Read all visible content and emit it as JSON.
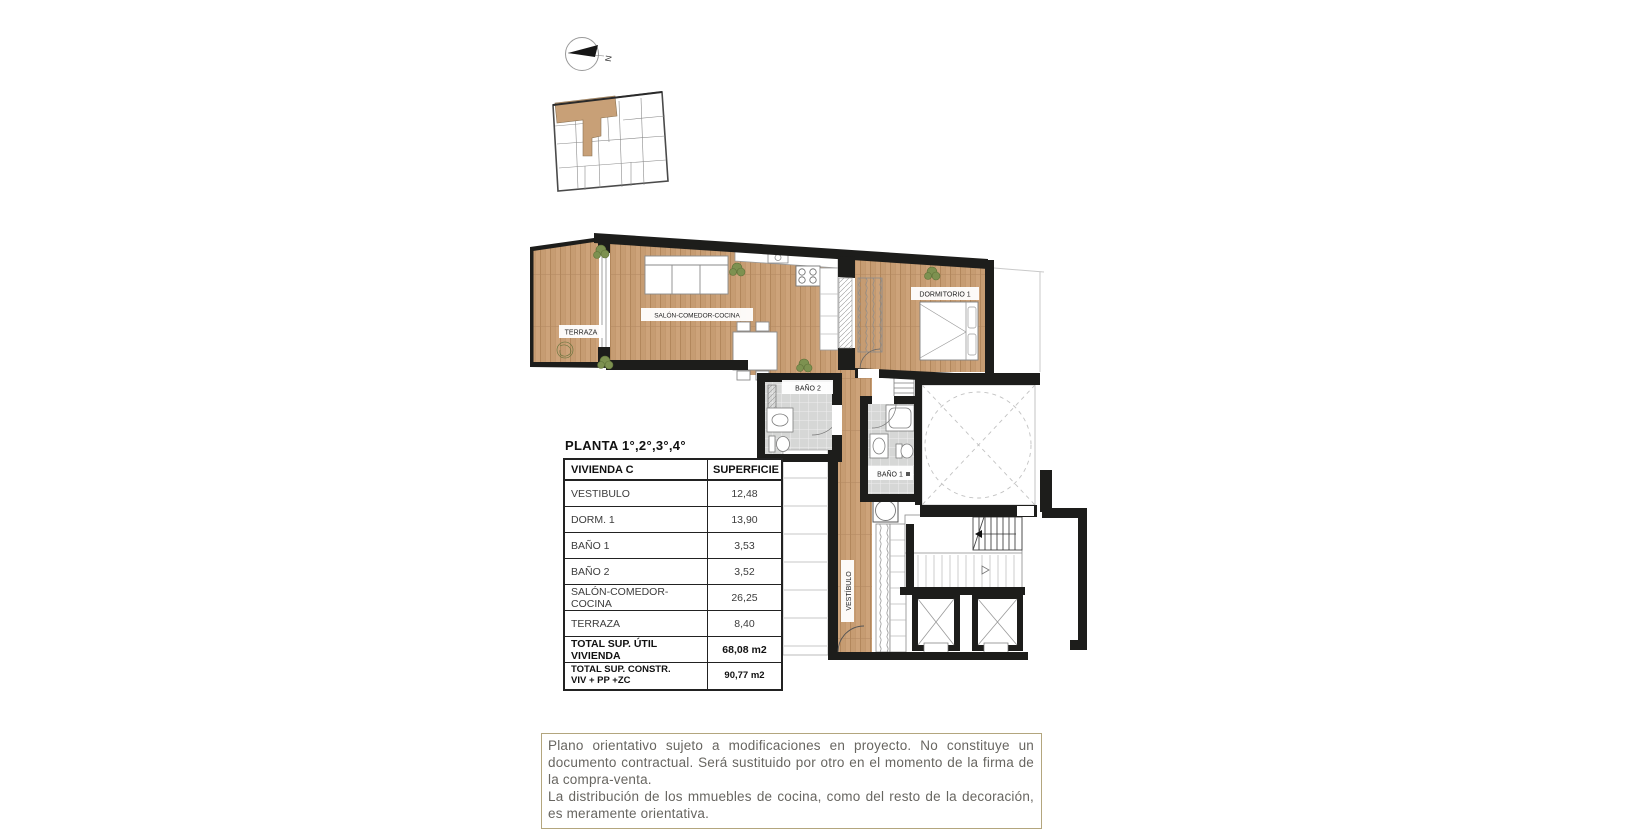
{
  "compass": {
    "north_label": "N"
  },
  "key_plan": {
    "description": "building key plan with unit highlighted"
  },
  "plan": {
    "labels": {
      "terraza": "TERRAZA",
      "salon": "SALÓN-COMEDOR-COCINA",
      "dormitorio": "DORMITORIO 1",
      "bano2": "BAÑO 2",
      "bano1": "BAÑO 1",
      "vestibulo": "VESTÍBULO"
    },
    "colors": {
      "wood": "#c69c72",
      "wall": "#1d1d1b",
      "tile": "#d6d7d6",
      "highlight_unit": "#c8a077"
    }
  },
  "table": {
    "title": "PLANTA 1°,2°,3°,4°",
    "header": {
      "col1": "VIVIENDA C",
      "col2": "SUPERFICIE"
    },
    "rows": [
      {
        "label": "VESTIBULO",
        "value": "12,48"
      },
      {
        "label": "DORM. 1",
        "value": "13,90"
      },
      {
        "label": "BAÑO 1",
        "value": "3,53"
      },
      {
        "label": "BAÑO 2",
        "value": "3,52"
      },
      {
        "label": "SALÓN-COMEDOR-COCINA",
        "value": "26,25"
      },
      {
        "label": "TERRAZA",
        "value": "8,40"
      }
    ],
    "totals": [
      {
        "label": "TOTAL SUP. ÚTIL VIVIENDA",
        "label2": "",
        "value": "68,08 m2"
      },
      {
        "label": "TOTAL SUP. CONSTR.",
        "label2": "VIV + PP +ZC",
        "value": "90,77 m2"
      }
    ]
  },
  "disclaimer": {
    "p1": "Plano orientativo sujeto a modificaciones en proyecto. No constituye un documento contractual. Será sustituido por otro en el momento de la firma de la compra-venta.",
    "p2": "La distribución de los mmuebles de cocina, como del resto de la decoración, es meramente orientativa."
  }
}
